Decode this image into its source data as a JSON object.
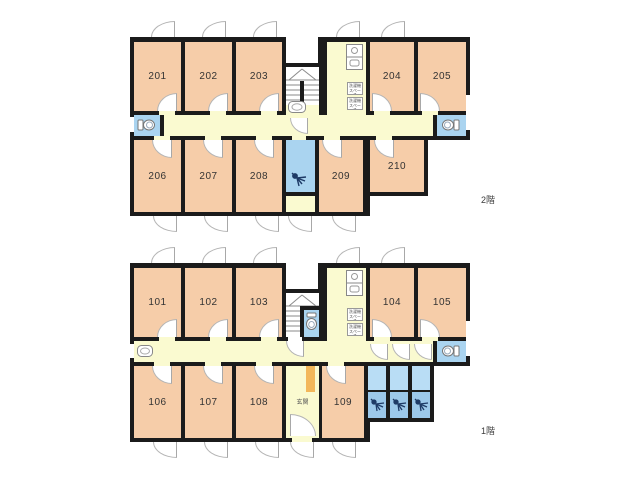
{
  "title": "apartment floor plan",
  "floors": {
    "f2": {
      "label": "2階",
      "rooms": {
        "r201": "201",
        "r202": "202",
        "r203": "203",
        "r204": "204",
        "r205": "205",
        "r206": "206",
        "r207": "207",
        "r208": "208",
        "r209": "209",
        "r210": "210"
      }
    },
    "f1": {
      "label": "1階",
      "entrance_label": "玄関",
      "rooms": {
        "r101": "101",
        "r102": "102",
        "r103": "103",
        "r104": "104",
        "r105": "105",
        "r106": "106",
        "r107": "107",
        "r108": "108",
        "r109": "109"
      }
    }
  },
  "fixtures": {
    "laundry_space_label": "洗濯機スペース"
  },
  "colors": {
    "wall": "#1b1b1b",
    "room_fill": "#f6cda9",
    "corridor_fill": "#fafad0",
    "water_blue": "#aad4f0",
    "shower_blue": "#9cc8ea",
    "genkan_orange": "#f3b75a"
  }
}
